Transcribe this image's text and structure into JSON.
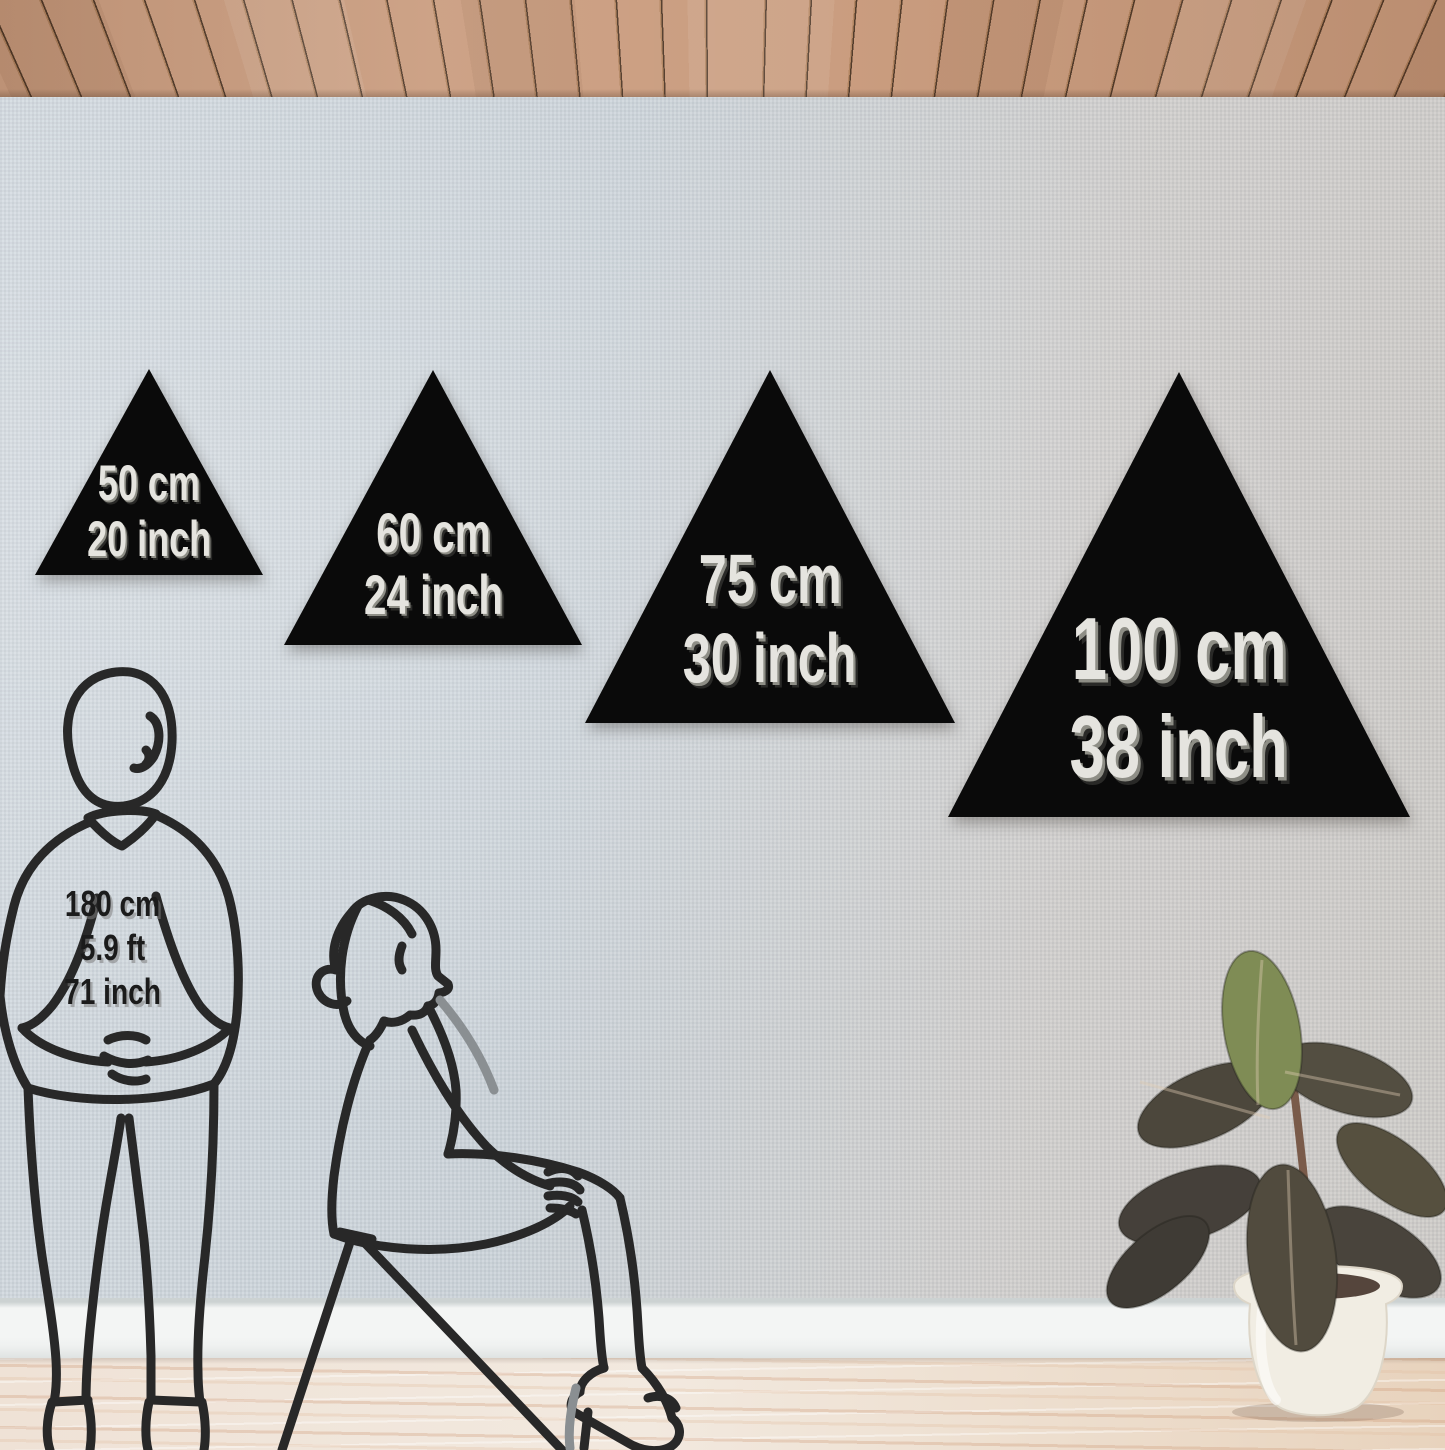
{
  "triangles": [
    {
      "cm": "50 cm",
      "inch": "20 inch"
    },
    {
      "cm": "60 cm",
      "inch": "24 inch"
    },
    {
      "cm": "75 cm",
      "inch": "30 inch"
    },
    {
      "cm": "100 cm",
      "inch": "38 inch"
    }
  ],
  "reference_person": {
    "height_cm": "180 cm",
    "height_ft": "5.9 ft",
    "height_inch": "71 inch"
  },
  "figures": {
    "man": "standing-man-line-art",
    "woman": "seated-woman-line-art",
    "plant": "rubber-plant-in-white-pot"
  },
  "colors": {
    "triangle_fill": "#0a0a0a",
    "triangle_label": "#e5e4df",
    "label_extrude": "#8e8e86",
    "wall_left": "#d3dae0",
    "wall_right": "#cfccc8",
    "ceiling_wood": "#c99b7d",
    "ceiling_groove": "#4f3827",
    "baseboard": "#eff1f0",
    "floor_light": "#f0e4d8",
    "floor_streak": "#d9b89c",
    "line_art": "#282828",
    "pot": "#f1ede3",
    "leaf_dark": "#4c473c",
    "leaf_green": "#7f8c55",
    "person_label": "#1b1b1b"
  }
}
